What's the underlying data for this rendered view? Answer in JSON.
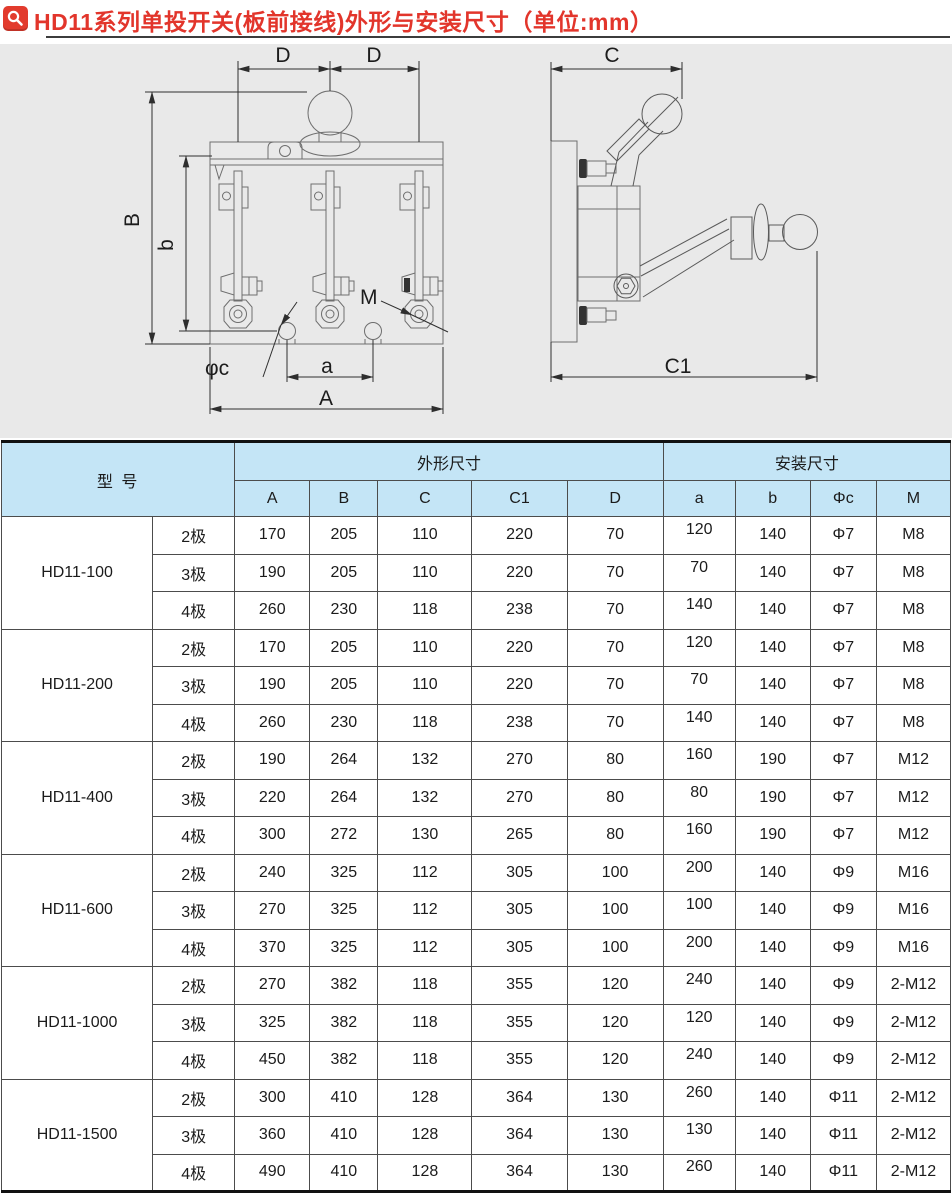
{
  "title": {
    "icon": "magnifier-icon",
    "text": "HD11系列单投开关(板前接线)外形与安装尺寸（单位:mm）",
    "accent_color": "#e2352b"
  },
  "colors": {
    "accent_red": "#e2352b",
    "table_header_bg": "#c4e5f6",
    "drawing_bg": "#e9e9e9",
    "border_dark": "#4c4c4c"
  },
  "drawing": {
    "front": {
      "d_left": "D",
      "d_right": "D",
      "height_total": "B",
      "height_inner": "b",
      "thread_label": "M",
      "hole_label": "φc",
      "hole_pitch": "a",
      "width_total": "A"
    },
    "side": {
      "depth": "C",
      "depth_total": "C1"
    }
  },
  "table": {
    "headers": {
      "model": "型 号",
      "shape": "外形尺寸",
      "install": "安装尺寸",
      "cols": [
        "A",
        "B",
        "C",
        "C1",
        "D",
        "a",
        "b",
        "Φc",
        "M"
      ]
    },
    "groups": [
      {
        "model": "HD11-100",
        "rows": [
          [
            "2极",
            "170",
            "205",
            "110",
            "220",
            "70",
            "120",
            "140",
            "Φ7",
            "M8"
          ],
          [
            "3极",
            "190",
            "205",
            "110",
            "220",
            "70",
            "70",
            "140",
            "Φ7",
            "M8"
          ],
          [
            "4极",
            "260",
            "230",
            "118",
            "238",
            "70",
            "140",
            "140",
            "Φ7",
            "M8"
          ]
        ]
      },
      {
        "model": "HD11-200",
        "rows": [
          [
            "2极",
            "170",
            "205",
            "110",
            "220",
            "70",
            "120",
            "140",
            "Φ7",
            "M8"
          ],
          [
            "3极",
            "190",
            "205",
            "110",
            "220",
            "70",
            "70",
            "140",
            "Φ7",
            "M8"
          ],
          [
            "4极",
            "260",
            "230",
            "118",
            "238",
            "70",
            "140",
            "140",
            "Φ7",
            "M8"
          ]
        ]
      },
      {
        "model": "HD11-400",
        "rows": [
          [
            "2极",
            "190",
            "264",
            "132",
            "270",
            "80",
            "160",
            "190",
            "Φ7",
            "M12"
          ],
          [
            "3极",
            "220",
            "264",
            "132",
            "270",
            "80",
            "80",
            "190",
            "Φ7",
            "M12"
          ],
          [
            "4极",
            "300",
            "272",
            "130",
            "265",
            "80",
            "160",
            "190",
            "Φ7",
            "M12"
          ]
        ]
      },
      {
        "model": "HD11-600",
        "rows": [
          [
            "2极",
            "240",
            "325",
            "112",
            "305",
            "100",
            "200",
            "140",
            "Φ9",
            "M16"
          ],
          [
            "3极",
            "270",
            "325",
            "112",
            "305",
            "100",
            "100",
            "140",
            "Φ9",
            "M16"
          ],
          [
            "4极",
            "370",
            "325",
            "112",
            "305",
            "100",
            "200",
            "140",
            "Φ9",
            "M16"
          ]
        ]
      },
      {
        "model": "HD11-1000",
        "rows": [
          [
            "2极",
            "270",
            "382",
            "118",
            "355",
            "120",
            "240",
            "140",
            "Φ9",
            "2-M12"
          ],
          [
            "3极",
            "325",
            "382",
            "118",
            "355",
            "120",
            "120",
            "140",
            "Φ9",
            "2-M12"
          ],
          [
            "4极",
            "450",
            "382",
            "118",
            "355",
            "120",
            "240",
            "140",
            "Φ9",
            "2-M12"
          ]
        ]
      },
      {
        "model": "HD11-1500",
        "rows": [
          [
            "2极",
            "300",
            "410",
            "128",
            "364",
            "130",
            "260",
            "140",
            "Φ11",
            "2-M12"
          ],
          [
            "3极",
            "360",
            "410",
            "128",
            "364",
            "130",
            "130",
            "140",
            "Φ11",
            "2-M12"
          ],
          [
            "4极",
            "490",
            "410",
            "128",
            "364",
            "130",
            "260",
            "140",
            "Φ11",
            "2-M12"
          ]
        ]
      }
    ]
  }
}
